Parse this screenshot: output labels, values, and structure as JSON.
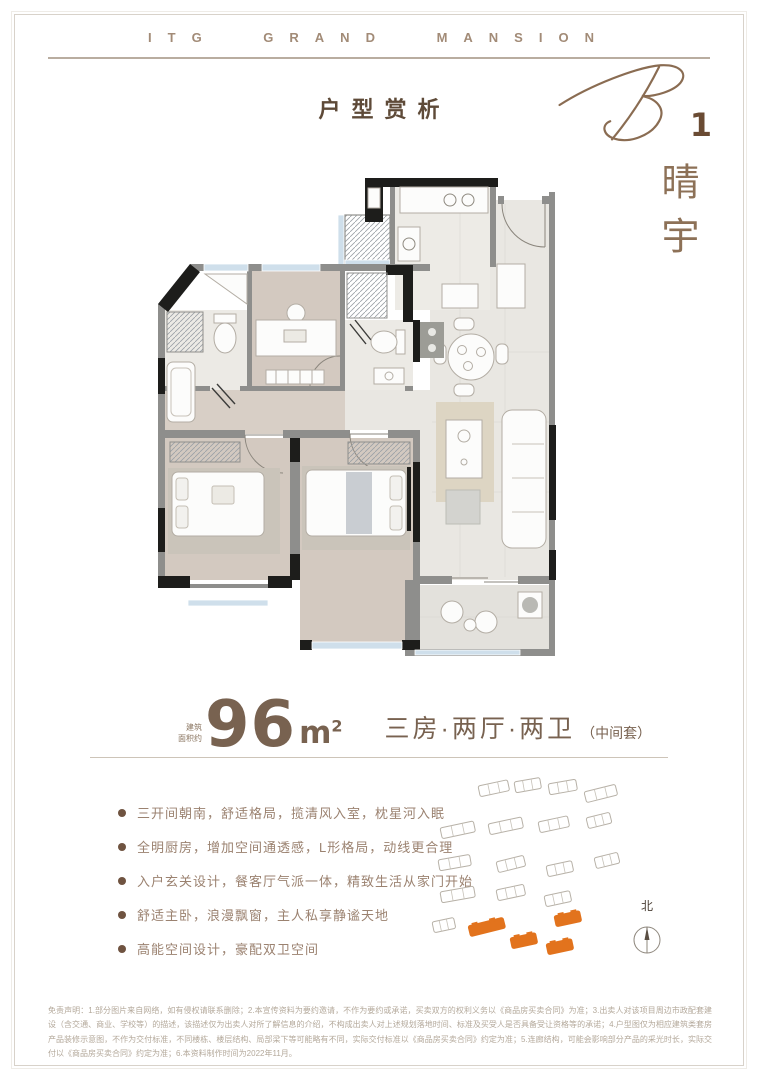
{
  "brand": {
    "logo_text": "ITG GRAND MANSION"
  },
  "page": {
    "section_title": "户型赏析"
  },
  "unit": {
    "code_letter": "B",
    "code_number": "1",
    "name_vertical": "晴宇"
  },
  "stats": {
    "area_label_line1": "建筑",
    "area_label_line2": "面积约",
    "area_value": "96",
    "area_unit": "m",
    "area_sup": "2",
    "layout": "三房·两厅·两卫",
    "layout_note": "（中间套）"
  },
  "features": [
    "三开间朝南，舒适格局，揽清风入室，枕星河入眠",
    "全明厨房，增加空间通透感，L形格局，动线更合理",
    "入户玄关设计，餐客厅气派一体，精致生活从家门开始",
    "舒适主卧，浪漫飘窗，主人私享静谧天地",
    "高能空间设计，豪配双卫空间"
  ],
  "site_plan": {
    "north_label": "北",
    "highlight_color": "#e2731d",
    "buildings": [
      {
        "x": 50,
        "y": 14,
        "w": 30,
        "rot": -12
      },
      {
        "x": 86,
        "y": 10,
        "w": 26,
        "rot": -10
      },
      {
        "x": 120,
        "y": 12,
        "w": 28,
        "rot": -10
      },
      {
        "x": 156,
        "y": 20,
        "w": 32,
        "rot": -14
      },
      {
        "x": 12,
        "y": 56,
        "w": 34,
        "rot": -12
      },
      {
        "x": 60,
        "y": 52,
        "w": 34,
        "rot": -12
      },
      {
        "x": 110,
        "y": 50,
        "w": 30,
        "rot": -12
      },
      {
        "x": 158,
        "y": 46,
        "w": 24,
        "rot": -14
      },
      {
        "x": 10,
        "y": 88,
        "w": 32,
        "rot": -10
      },
      {
        "x": 68,
        "y": 90,
        "w": 28,
        "rot": -14
      },
      {
        "x": 118,
        "y": 94,
        "w": 26,
        "rot": -12
      },
      {
        "x": 166,
        "y": 86,
        "w": 24,
        "rot": -14
      },
      {
        "x": 12,
        "y": 120,
        "w": 34,
        "rot": -10
      },
      {
        "x": 68,
        "y": 118,
        "w": 28,
        "rot": -12
      },
      {
        "x": 116,
        "y": 124,
        "w": 26,
        "rot": -12
      },
      {
        "x": 4,
        "y": 150,
        "w": 22,
        "rot": -12
      },
      {
        "x": 126,
        "y": 144,
        "w": 26,
        "rot": -12,
        "highlight": true
      },
      {
        "x": 40,
        "y": 154,
        "w": 36,
        "rot": -14,
        "highlight": true
      },
      {
        "x": 82,
        "y": 166,
        "w": 26,
        "rot": -12,
        "highlight": true
      },
      {
        "x": 118,
        "y": 172,
        "w": 26,
        "rot": -12,
        "highlight": true
      }
    ]
  },
  "disclaimer": "免责声明：1.部分图片来自网络，如有侵权请联系删除；2.本宣传资料为要约邀请，不作为要约或承诺，买卖双方的权利义务以《商品房买卖合同》为准；3.出卖人对该项目周边市政配套建设（含交通、商业、学校等）的描述，该描述仅为出卖人对所了解信息的介绍，不构成出卖人对上述规划落地时间、标准及买受人是否具备受让资格等的承诺；4.户型图仅为相应建筑类套房产品装修示意图，不作为交付标准，不同楼栋、楼层结构、局部梁下等可能略有不同，实际交付标准以《商品房买卖合同》约定为准；5.连廊结构，可能会影响部分产品的采光时长，实际交付以《商品房买卖合同》约定为准；6.本资料制作时间为2022年11月。",
  "colors": {
    "accent_brown": "#8a6c52",
    "orange": "#e2731d"
  }
}
